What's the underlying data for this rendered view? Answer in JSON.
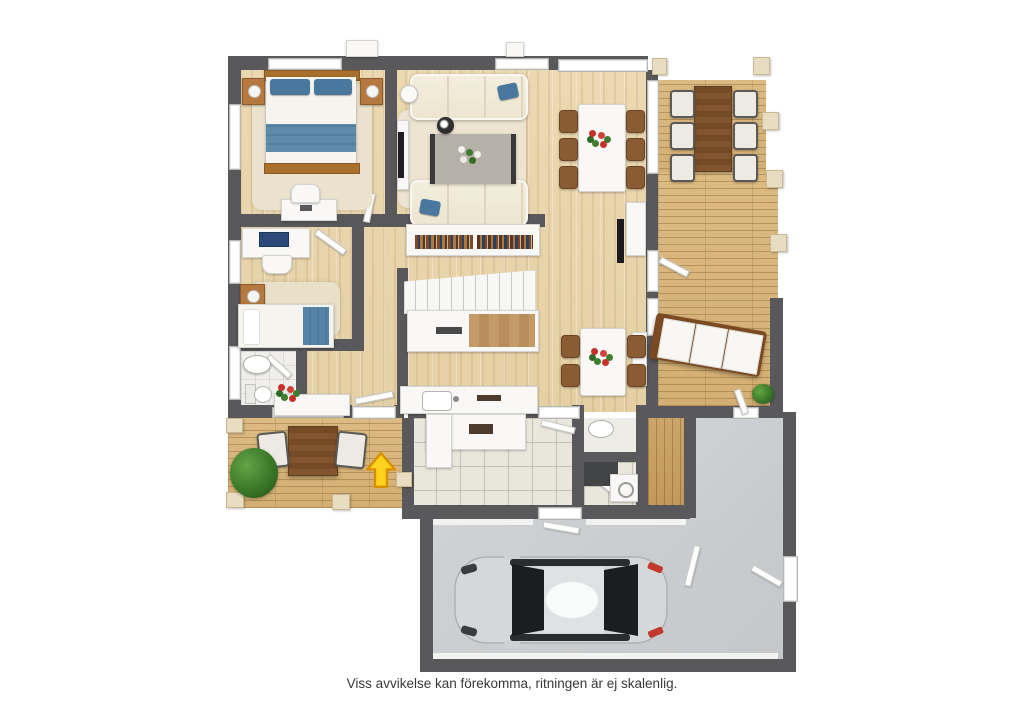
{
  "caption": "Viss avvikelse kan förekomma, ritningen är ej skalenlig.",
  "palette": {
    "wall": "#59595b",
    "interior_wood_floor": "#e8d4ab",
    "deck_wood": "#d8b77d",
    "sauna_wood": "#cda56a",
    "entry_tile": "#e9e6db",
    "concrete_floor": "#cbced0",
    "accent_blue_textile": "#49779e",
    "bed_frame_wood": "#a9702e",
    "outdoor_table_wood": "#82552e",
    "entrance_arrow_fill": "#ffd21e",
    "entrance_arrow_outline": "#d98f00",
    "flower_red": "#c62f2a",
    "plant_green": "#3a7828",
    "car_body": "#d5d7d9"
  }
}
